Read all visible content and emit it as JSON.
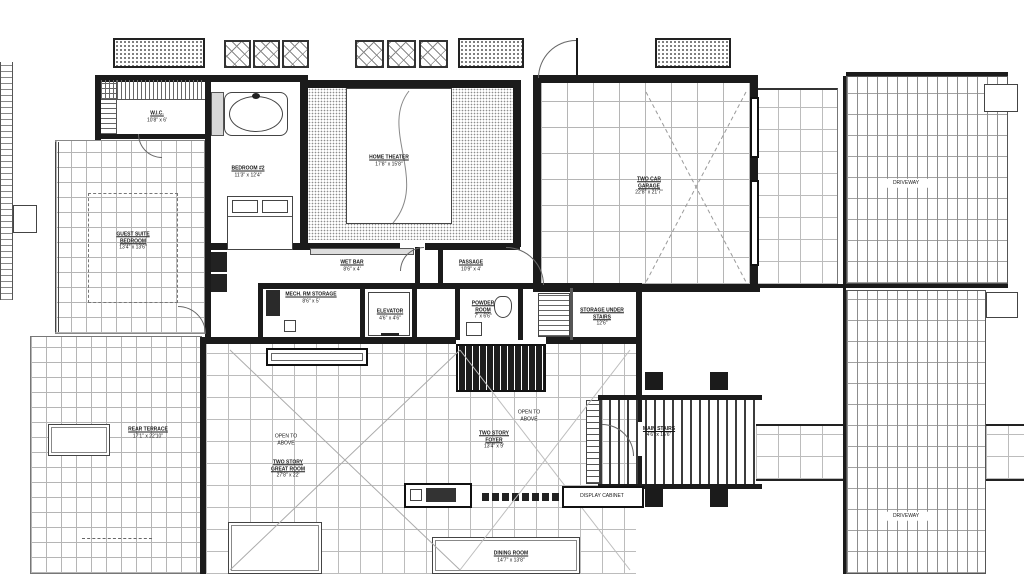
{
  "plan": {
    "driveway_label": "DRIVEWAY",
    "open_to_above": "OPEN TO ABOVE",
    "rooms": {
      "wic": {
        "name": "W.I.C.",
        "dims": "10'8\" x 6'"
      },
      "guest_suite": {
        "name": "GUEST SUITE BEDROOM",
        "dims": "13'4\" x 13'6\""
      },
      "bedroom_2": {
        "name": "BEDROOM #2",
        "dims": "11'3\" x 12'4\""
      },
      "home_theater": {
        "name": "HOME THEATER",
        "dims": "17'8\" x 15'8\""
      },
      "garage": {
        "name": "TWO CAR GARAGE",
        "dims": "22'8\" x 21'7\""
      },
      "wet_bar": {
        "name": "WET BAR",
        "dims": "8'6\" x 4'"
      },
      "mech_storage": {
        "name": "MECH. RM STORAGE",
        "dims": "8'6\" x 5'"
      },
      "elevator": {
        "name": "ELEVATOR",
        "dims": "4'6\" x 4'6\""
      },
      "passage": {
        "name": "PASSAGE",
        "dims": "10'9\" x 4'"
      },
      "powder_room": {
        "name": "POWDER ROOM",
        "dims": "7' x 6'6\""
      },
      "storage_under_stairs": {
        "name": "STORAGE UNDER STAIRS",
        "dims": "12'6\""
      },
      "rear_terrace": {
        "name": "REAR TERRACE",
        "dims": "17'1\" x 22'10\""
      },
      "great_room": {
        "name": "TWO STORY GREAT ROOM",
        "dims": "27'8\" x 22'"
      },
      "foyer": {
        "name": "TWO STORY FOYER",
        "dims": "13'4\" x 9'"
      },
      "main_stairs": {
        "name": "MAIN STAIRS",
        "dims": "4'6\" x 16'6\""
      },
      "dining_room": {
        "name": "DINING ROOM",
        "dims": "14'7\" x 13'8\""
      },
      "display_cabinet": {
        "name": "DISPLAY CABINET"
      }
    }
  }
}
